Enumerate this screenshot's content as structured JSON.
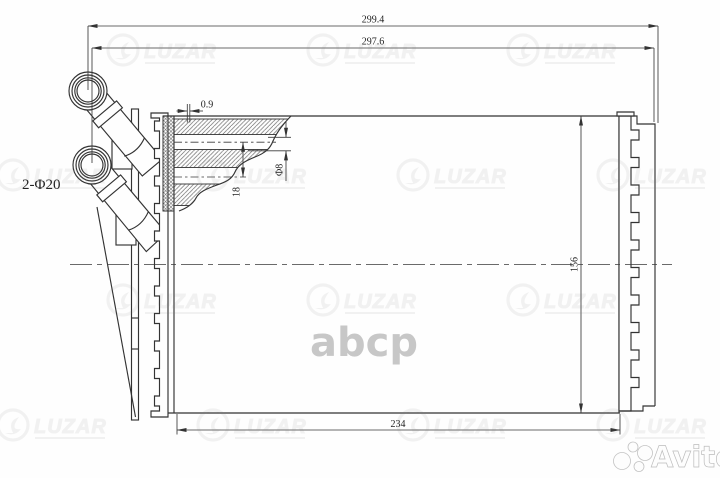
{
  "dimensions": {
    "overall_width_top": "299.4",
    "overall_width_inner": "297.6",
    "core_width_bottom": "234",
    "core_height": "156",
    "wall_thickness": "0.9",
    "tube_pitch": "18",
    "tube_diameter": "Φ8",
    "pipe_ports_label": "2-Φ20"
  },
  "watermarks": {
    "brand_logo_text": "LUZAR",
    "center_text": "abcp",
    "marketplace_text": "Avito"
  },
  "colors": {
    "line": "#333333",
    "background": "#fefefe",
    "watermark_gray": "#b5b5b5",
    "avito_white": "#fdfdfd"
  }
}
